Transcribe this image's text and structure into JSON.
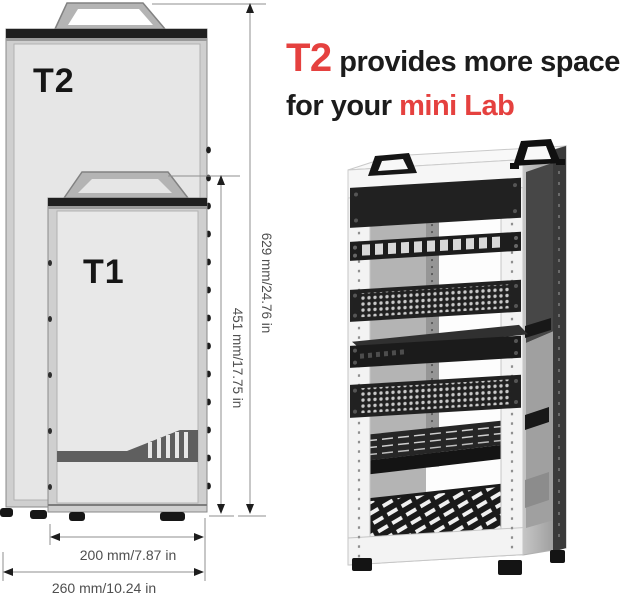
{
  "headline": {
    "t2": "T2",
    "line1_rest": " provides more space",
    "line2_prefix": "for your ",
    "line2_accent": "mini Lab"
  },
  "diagram": {
    "cabinet_large_label": "T2",
    "cabinet_small_label": "T1",
    "dim_height_large": "629 mm/24.76 in",
    "dim_height_small": "451 mm/17.75 in",
    "dim_width_small": "200 mm/7.87 in",
    "dim_width_large": "260 mm/10.24 in"
  },
  "colors": {
    "accent_red": "#e5413f",
    "headline_text": "#1c1c1c",
    "cabinet_panel": "#e6e6e6",
    "cabinet_frame": "#cfcfcf",
    "cabinet_top_strip": "#1f1f1f",
    "dimension_line": "#8f8f8f",
    "dimension_text": "#4f4f4f",
    "rack_frame_white": "#f3f3f3",
    "rack_panel_black": "#212121",
    "rack_side_gray": "#a8a8a8"
  }
}
